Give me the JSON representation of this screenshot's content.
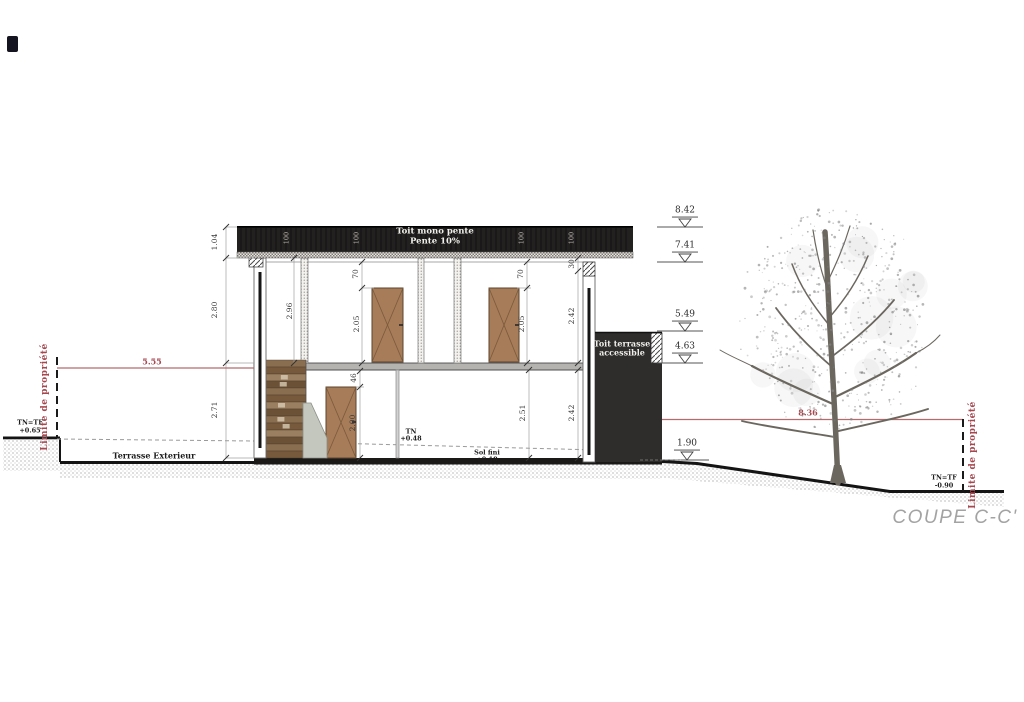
{
  "title": "COUPE C-C'",
  "colors": {
    "accent_red": "#a6474f",
    "red_line": "#b56a6d",
    "roof_dark": "#232120",
    "volume_dark": "#2f2d2c",
    "door_brown": "#a67c59",
    "title_gray": "#a3a3a3"
  },
  "roof": {
    "label_line1": "Toit mono pente",
    "label_line2": "Pente 10%",
    "marks": [
      "100",
      "100",
      "100",
      "100"
    ]
  },
  "levels": [
    {
      "value": "8.42"
    },
    {
      "value": "7.41"
    },
    {
      "value": "5.49"
    },
    {
      "value": "4.63"
    },
    {
      "value": "1.90"
    }
  ],
  "red_dimensions": {
    "left": "5.55",
    "right": "8.36"
  },
  "boundary_left": {
    "label": "Limite de propriété",
    "ref": "TN=TF",
    "elev": "+0.65"
  },
  "boundary_right": {
    "label": "Limite de propriété",
    "ref": "TN=TF",
    "elev": "-0.90"
  },
  "ground_labels": {
    "terrace": "Terrasse Exterieur",
    "tn_ref": "TN",
    "tn_elev": "+0.48",
    "sol_ref": "Sol fini",
    "sol_elev": "+0.18"
  },
  "roof_terrace": {
    "line1": "Toit terrasse",
    "line2": "accessible"
  },
  "dims": {
    "roof_thickness": "1.04",
    "upper_floor_height": "2.80",
    "ground_floor_height": "2.71",
    "stair_bay_height": "2.96",
    "upper_door1_head": "70",
    "upper_door1_height": "2.05",
    "upper_door2_head": "70",
    "upper_door2_height": "2.05",
    "roof_edge": "30",
    "upper_right_height": "2.42",
    "gf_door_head": "46",
    "gf_door_height": "2.00",
    "gf_height_mid": "2.51",
    "gf_height_right": "2.42"
  }
}
